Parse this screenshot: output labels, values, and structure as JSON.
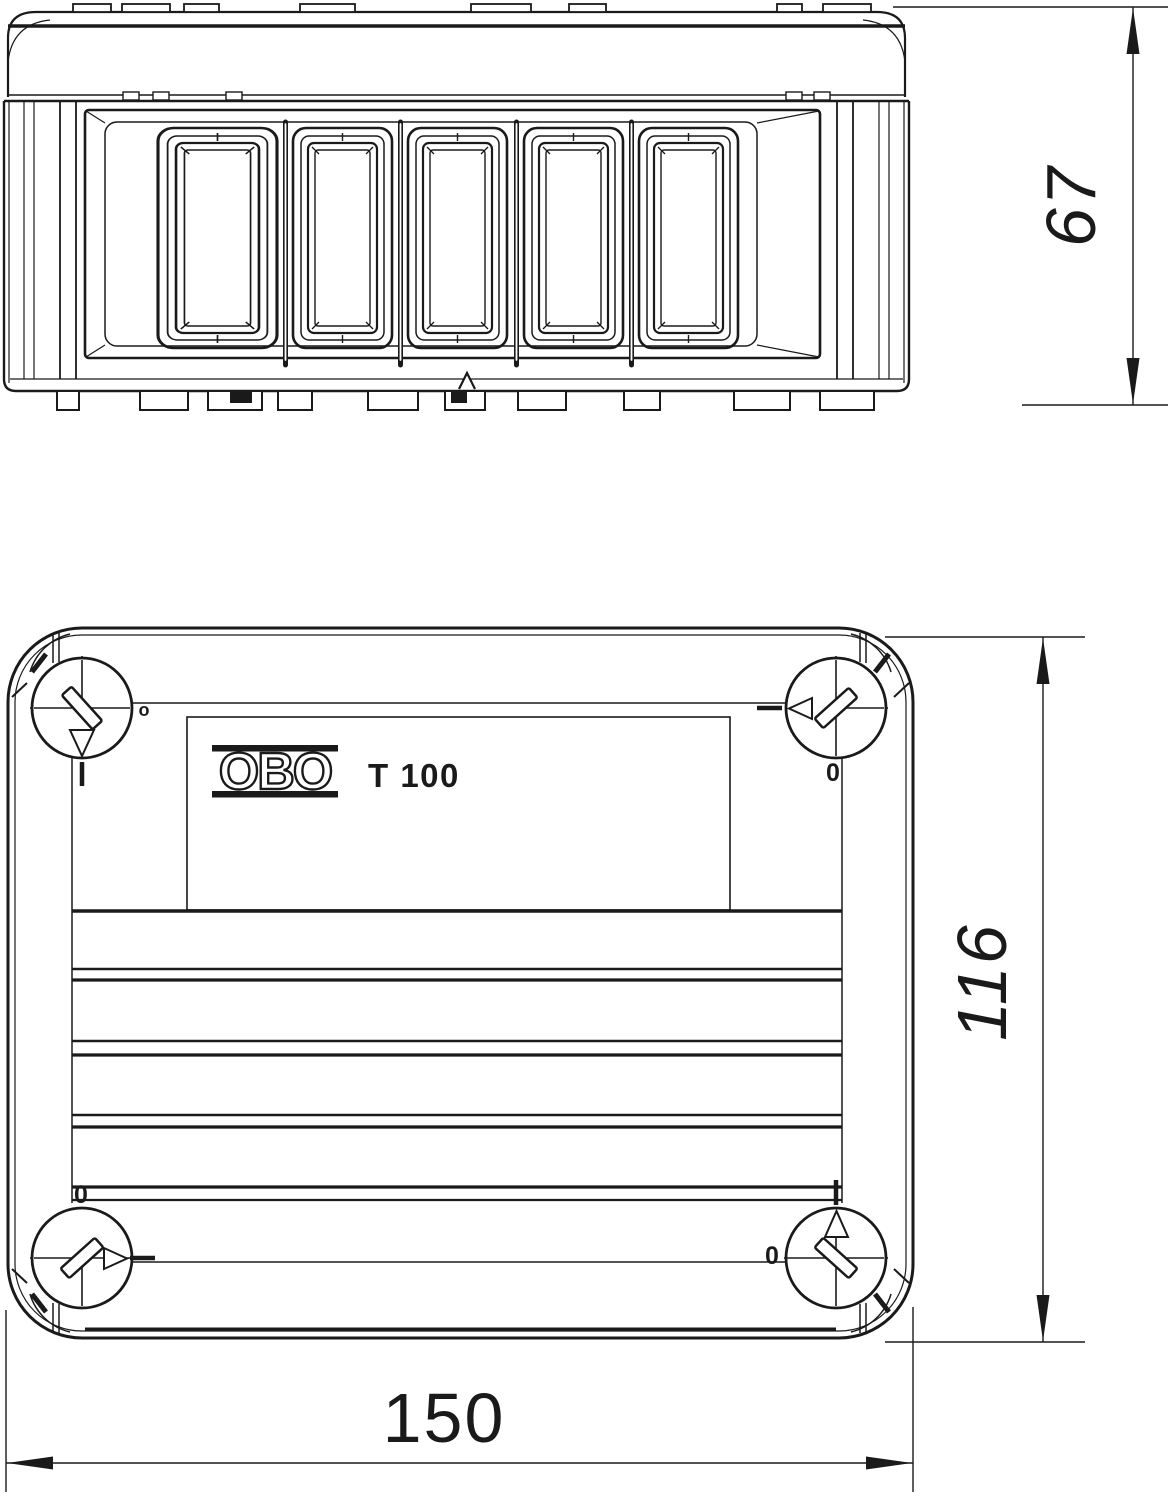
{
  "drawing": {
    "type": "technical-dimension-drawing",
    "product_label": {
      "brand": "OBO",
      "model": "T 100"
    },
    "dimensions": {
      "side_height": "67",
      "plan_height": "116",
      "plan_width": "150"
    },
    "screw_markers": {
      "top_left": "o",
      "top_right": "0",
      "bottom_left": "0",
      "bottom_right": "0"
    },
    "colors": {
      "line": "#1a1a1a",
      "background": "#ffffff"
    }
  }
}
